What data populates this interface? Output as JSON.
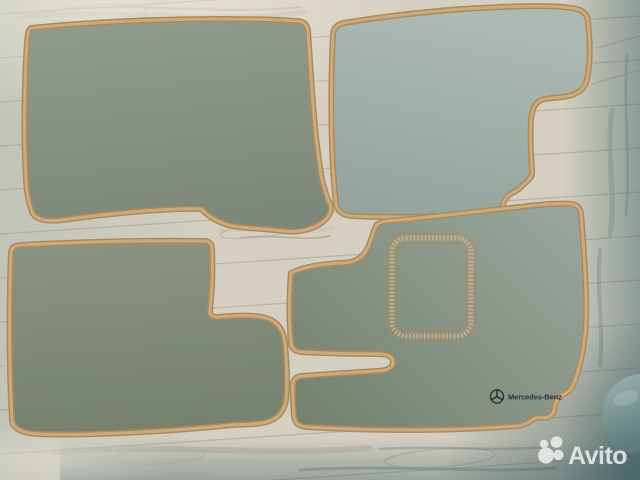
{
  "image": {
    "subject": "Set of four Mercedes-Benz car floor mats laid out on a light wooden laminate floor, seller photo with watermark"
  },
  "branding": {
    "mercedes_text": "Mercedes-Benz"
  },
  "watermark": {
    "text": "Avito"
  },
  "colors": {
    "floor_base": "#d4cfc1",
    "floor_seam": "#a39b89",
    "binding_tan": "#cbab7d",
    "binding_dark": "#aa8a5c",
    "mat_top_left_light": "#929c8e",
    "mat_top_left_dark": "#7d887a",
    "mat_top_right_light": "#adb9b3",
    "mat_top_right_dark": "#92a39c",
    "mat_bottom_left_light": "#8a9480",
    "mat_bottom_left_dark": "#77826e",
    "mat_driver_light": "#98a59c",
    "mat_driver_dark": "#76826f",
    "embroidery_dark": "#2a323a",
    "watermark_white": "#f0f0ee",
    "sock_light": "#9db6b0",
    "sock_dark": "#5d7d7b"
  }
}
